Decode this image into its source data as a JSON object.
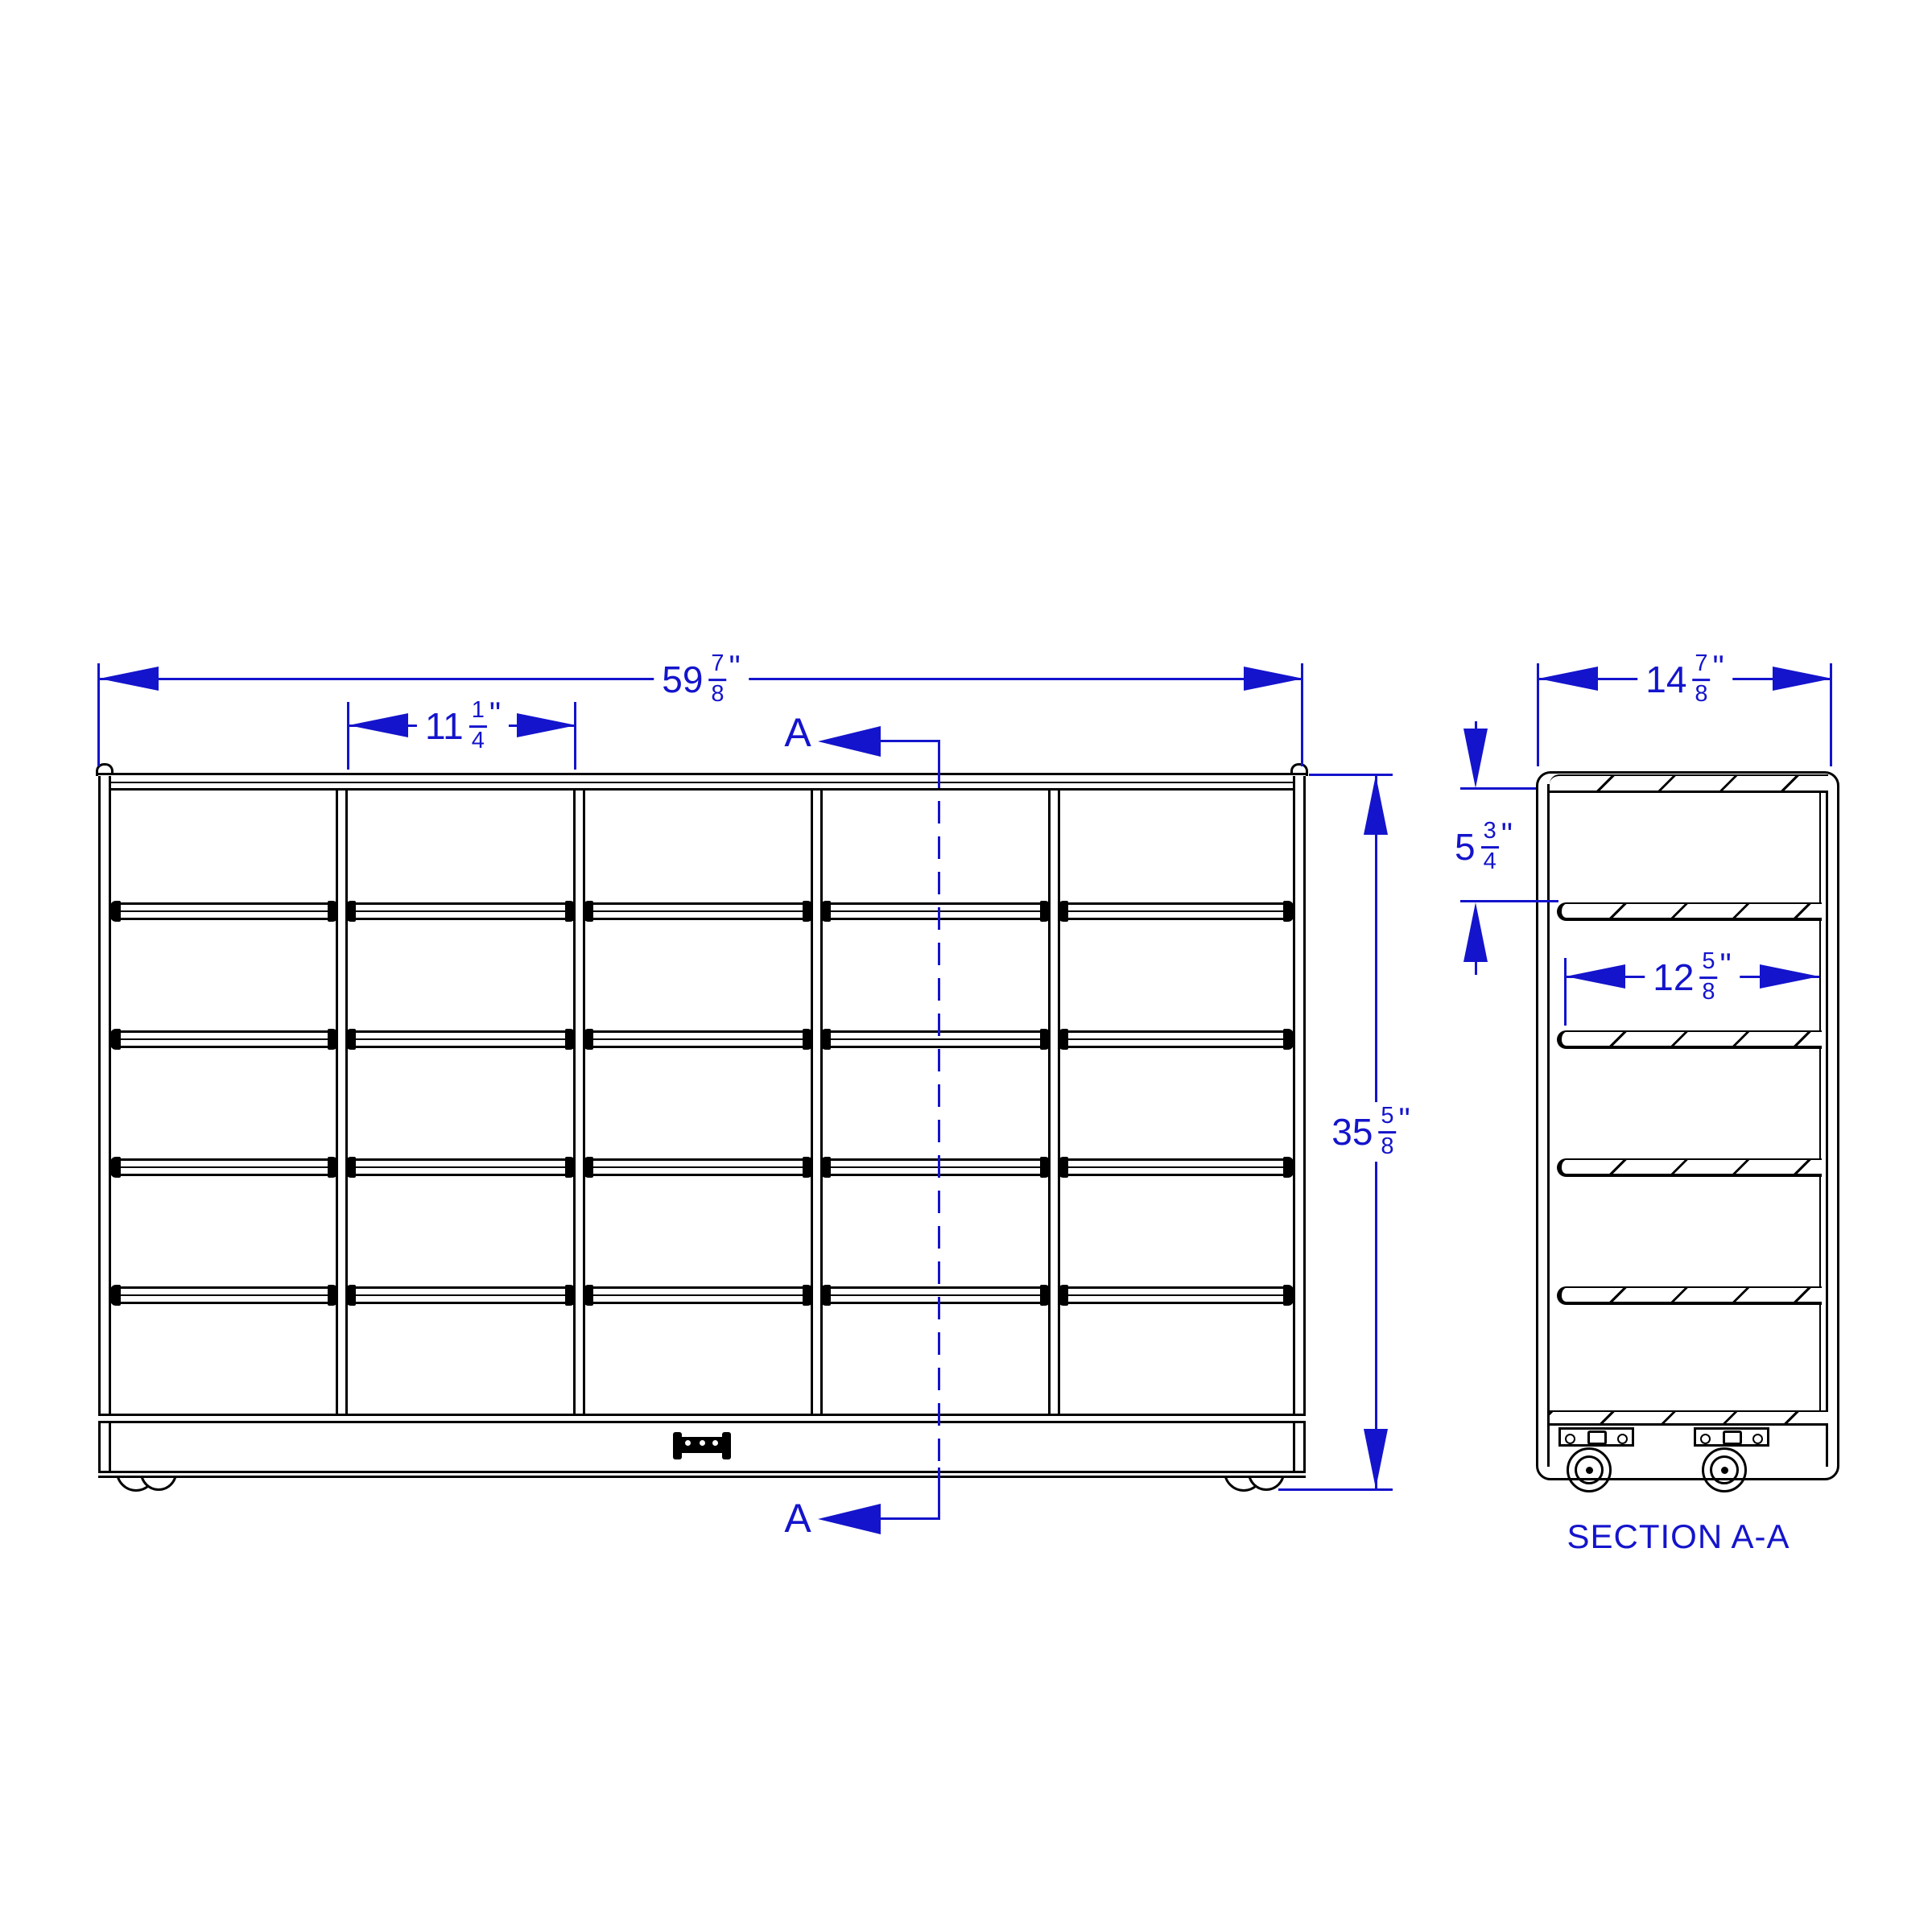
{
  "colors": {
    "line": "#000000",
    "dimension": "#1414cc",
    "background": "#ffffff"
  },
  "front_view": {
    "dim_width": {
      "whole": "59",
      "num": "7",
      "den": "8",
      "unit": "\""
    },
    "dim_column_width": {
      "whole": "11",
      "num": "1",
      "den": "4",
      "unit": "\""
    },
    "dim_height": {
      "whole": "35",
      "num": "5",
      "den": "8",
      "unit": "\""
    },
    "section_marker_top": "A",
    "section_marker_bottom": "A",
    "columns": 5,
    "tray_rail_rows": 4
  },
  "section_view": {
    "title": "SECTION A-A",
    "dim_depth": {
      "whole": "14",
      "num": "7",
      "den": "8",
      "unit": "\""
    },
    "dim_top_opening_height": {
      "whole": "5",
      "num": "3",
      "den": "4",
      "unit": "\""
    },
    "dim_shelf_depth": {
      "whole": "12",
      "num": "5",
      "den": "8",
      "unit": "\""
    },
    "shelf_count": 4,
    "caster_count": 2
  }
}
